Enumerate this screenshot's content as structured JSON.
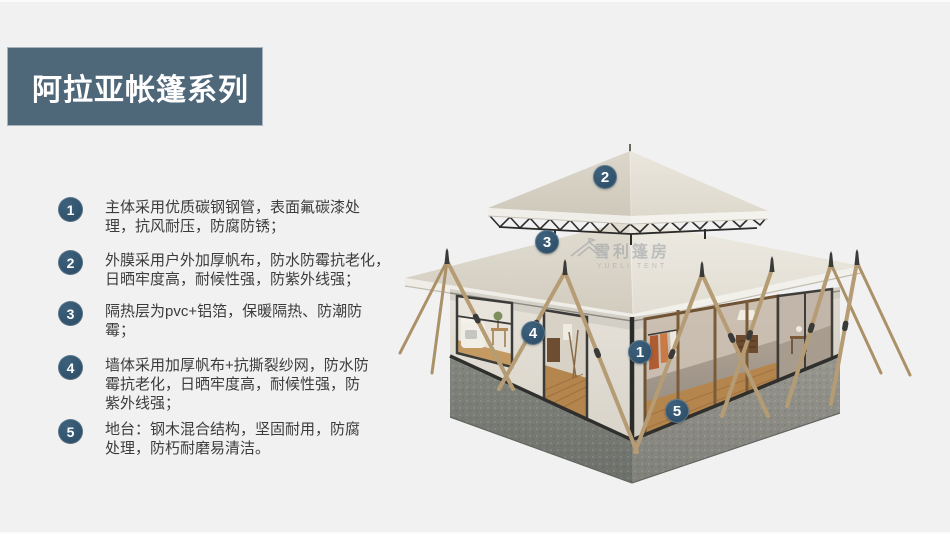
{
  "page": {
    "background": "#f1f1f2"
  },
  "header": {
    "title": "阿拉亚帐篷系列",
    "banner_color": "#4e6779",
    "text_color": "#ffffff"
  },
  "features": {
    "badge_color": "#2e4f68",
    "items": [
      {
        "num": "1",
        "lines": [
          "主体采用优质碳钢钢管，表面氟碳漆处",
          "理，抗风耐压，防腐防锈；"
        ]
      },
      {
        "num": "2",
        "lines": [
          "外膜采用户外加厚帆布，防水防霉抗老化，",
          "日晒牢度高，耐候性强，防紫外线强；"
        ]
      },
      {
        "num": "3",
        "lines": [
          "隔热层为pvc+铝箔，保暖隔热、防潮防",
          "霉；"
        ]
      },
      {
        "num": "4",
        "lines": [
          "墙体采用加厚帆布+抗撕裂纱网，防水防",
          "霉抗老化，日晒牢度高，耐候性强，防",
          "紫外线强；"
        ]
      },
      {
        "num": "5",
        "lines": [
          "地台：钢木混合结构，坚固耐用，防腐",
          "处理，防朽耐磨易清洁。"
        ]
      }
    ]
  },
  "diagram": {
    "markers": [
      {
        "label": "1"
      },
      {
        "label": "2"
      },
      {
        "label": "3"
      },
      {
        "label": "4"
      },
      {
        "label": "5"
      }
    ],
    "watermark": {
      "cn": "雪利篷房",
      "en": "YUELI TENT"
    }
  }
}
